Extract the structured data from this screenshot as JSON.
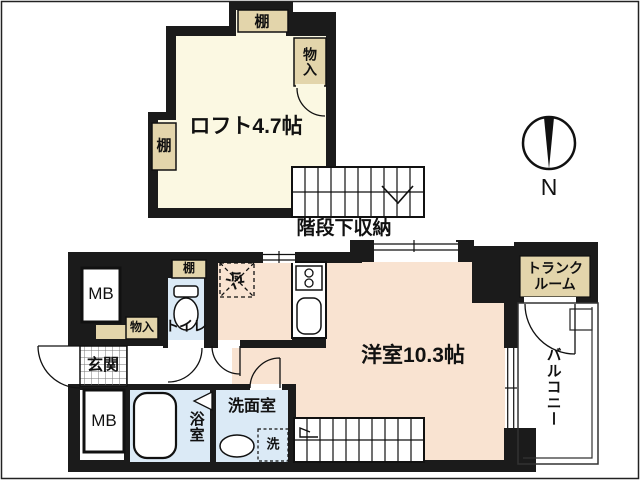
{
  "colors": {
    "wall": "#1b1b1b",
    "loft_floor": "#fbf8e2",
    "room_floor": "#f9e3d1",
    "wet_floor": "#dbeaf6",
    "shelf_fill": "#e3d5ab",
    "line": "#111111"
  },
  "loft": {
    "shelf_top": "棚",
    "closet": "物入",
    "name": "ロフト4.7帖",
    "shelf_left": "棚"
  },
  "stairs": {
    "note": "階段下収納"
  },
  "compass": {
    "north": "N"
  },
  "floor": {
    "mb_top": "MB",
    "toilet_shelf": "棚",
    "toilet": "トイレ",
    "closet": "物入",
    "entrance": "玄関",
    "fridge": "冷",
    "room": "洋室10.3帖",
    "trunk_room": [
      "トランク",
      "ルーム"
    ],
    "balcony": "バルコニー",
    "mb_bottom": "MB",
    "bath": "浴室",
    "washroom": "洗面室",
    "washer": "洗"
  }
}
